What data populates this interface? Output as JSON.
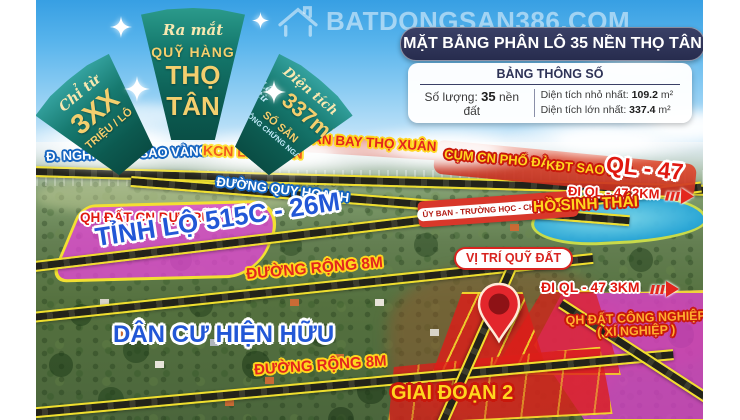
{
  "palette": {
    "banner_teal": "#0d5a50",
    "banner_gold": "#f2c75e",
    "header_navy": "#2e3357",
    "label_blue": "#2257d6",
    "label_red": "#e01810",
    "label_yellow": "#ffd61f",
    "road_yellow": "#f0df2e",
    "zone_pink": "#eb46dc",
    "plot_red": "#de1c18",
    "lake_blue": "#29a9dd"
  },
  "watermark": {
    "icon": "house-icon",
    "text": "BATDONGSAN386.COM"
  },
  "banner": {
    "left": {
      "script": "Chỉ từ",
      "value": "3XX",
      "unit": "TRIỆU / LÔ"
    },
    "center": {
      "script": "Ra mắt",
      "line1": "QUỸ HÀNG",
      "line2": "THỌ TÂN"
    },
    "right": {
      "script": "Diện tích",
      "prefix": "Lên từ",
      "value": "337m²",
      "line1": "SỔ SẴN",
      "line2": "CÔNG CHỨNG NGAY"
    }
  },
  "header": {
    "title": "MẶT BẰNG PHÂN LÔ 35 NỀN THỌ TÂN"
  },
  "info_panel": {
    "title": "BẢNG THÔNG SỐ",
    "quantity_label": "Số lượng:",
    "quantity_value": "35",
    "quantity_unit": "nền đất",
    "min_label": "Diện tích nhỏ nhất:",
    "min_value": "109.2",
    "min_unit": "m²",
    "max_label": "Diện tích lớn nhất:",
    "max_value": "337.4",
    "max_unit": "m²"
  },
  "map": {
    "road_nghi_son": "Đ. NGHI SƠN - SAO VÀNG",
    "kcn_lam_son": "KCN LAM SƠN",
    "san_bay": "SÂN BAY THỌ XUÂN",
    "cum_cn": "CỤM CN PHỐ ĐÀ",
    "kdt_sao_mai": "KĐT SAO MAI",
    "ql47": "QL - 47",
    "duong_quy_hoach": "ĐƯỜNG QUY HOẠCH",
    "di_ql47_2km": "ĐI QL - 47  2KM",
    "uy_ban": "ỦY BAN - TRƯỜNG HỌC - CHỢ",
    "khoang_cach": "1KM",
    "ho_sinh_thai": "HỒ SINH THÁI",
    "qh_dat_cn_du_tru": "QH ĐẤT CN DỰ TRỮ",
    "tinh_lo": "TỈNH LỘ 515C - 26M",
    "duong_rong_8m_giua": "ĐƯỜNG RỘNG 8M",
    "vi_tri": "VỊ TRÍ QUỸ ĐẤT",
    "di_ql47_3km": "ĐI QL - 47  3KM",
    "dan_cu": "DÂN CƯ HIỆN HỮU",
    "qh_cong_nghiep_line1": "QH ĐẤT CÔNG NGHIỆP",
    "qh_cong_nghiep_line2": "( XÍ NGHIỆP )",
    "duong_rong_8m_duoi": "ĐƯỜNG RỘNG 8M",
    "giai_doan": "GIAI ĐOẠN 2"
  }
}
